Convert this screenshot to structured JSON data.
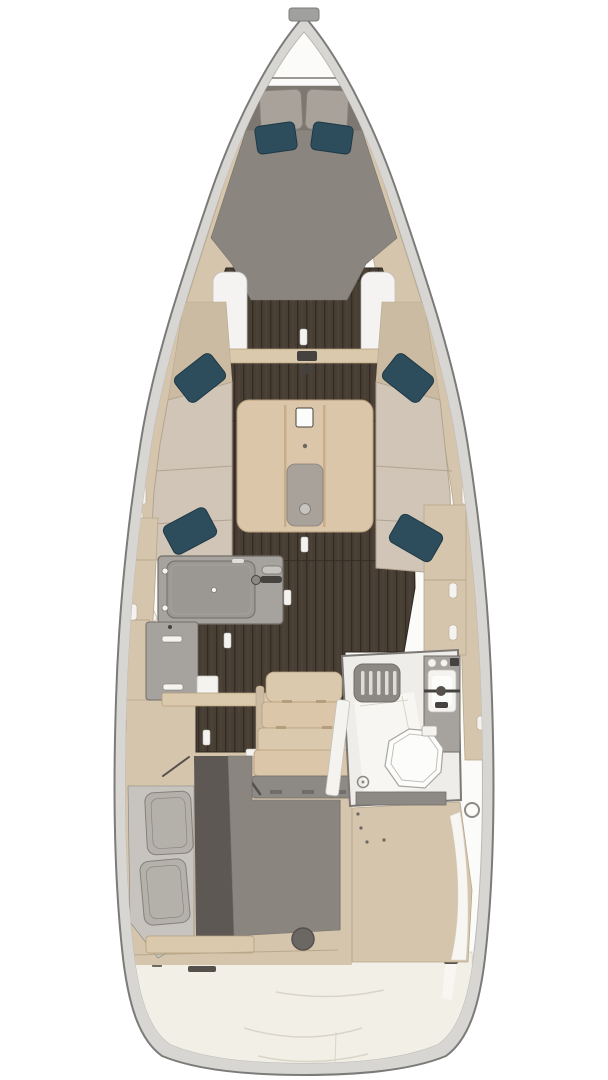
{
  "plan": {
    "type": "sailboat-interior-floor-plan",
    "view": "top-down",
    "areas": [
      {
        "id": "bow-anchor-locker"
      },
      {
        "id": "forward-cabin-vberth"
      },
      {
        "id": "saloon-with-table-and-settees"
      },
      {
        "id": "galley-port"
      },
      {
        "id": "companionway-steps"
      },
      {
        "id": "heads-starboard"
      },
      {
        "id": "aft-cabin-port"
      },
      {
        "id": "aft-storage-starboard"
      },
      {
        "id": "stern-platform"
      }
    ],
    "icons": [
      {
        "id": "stove-icon"
      },
      {
        "id": "sink-faucet-icon"
      },
      {
        "id": "toilet-icon"
      },
      {
        "id": "shower-grate-icon"
      },
      {
        "id": "pillow-icon"
      },
      {
        "id": "hatch-icon"
      }
    ]
  },
  "palette": {
    "page_bg": "#ffffff",
    "hull_outline": "#7b7b79",
    "hull_band": "#d8d6d3",
    "hull_inner": "#fbfbf9",
    "inner_line": "#bcbab7",
    "bow_cap": "#a0a09e",
    "deck_wood": "#d5c5ac",
    "deck_wood_edge": "#b7a78c",
    "deck_wood_dark": "#cbbba2",
    "furniture_wood": "#dbc9ad",
    "furniture_wood_edge": "#b49e7c",
    "table_wood": "#dcc6a9",
    "table_groove": "#c7ad8a",
    "floor_base": "#473e34",
    "floor_groove": "#342c24",
    "floor_streak": "#5a4c3e",
    "cushion": "#d0c5b6",
    "cushion_edge": "#b2a491",
    "berth_gray": "#8b8580",
    "berth_edge": "#76716c",
    "headboard": "#7d7771",
    "berth_dark": "#5d5854",
    "berth_light": "#c7c4c0",
    "pillow_gray": "#a8a29a",
    "pillow_gray_edge": "#868079",
    "pillow_teal": "#2d4d5c",
    "pillow_teal_edge": "#1f3945",
    "aft_pillow": "#b4b0aa",
    "counter": "#a6a39f",
    "counter_edge": "#716d69",
    "stove_gray": "#9b9793",
    "fixture_white": "#f4f3f0",
    "fixture_edge": "#c2c0bc",
    "dark_metal": "#46423f",
    "heads_floor": "#eeede9",
    "heads_floor_bright": "#f7f6f3",
    "heads_wall": "#7c7874",
    "grate": "#8c8884",
    "grate_slat": "#dedcd8",
    "toilet": "#fcfcfa",
    "toilet_edge": "#a8a5a1",
    "sill_gray": "#8d8985",
    "hatch_dark": "#6b6763",
    "stern_cream": "#f2efe6",
    "stern_line": "#d9d5c8",
    "white_liner": "#f4f3f1",
    "seam_dark": "#55504c"
  }
}
